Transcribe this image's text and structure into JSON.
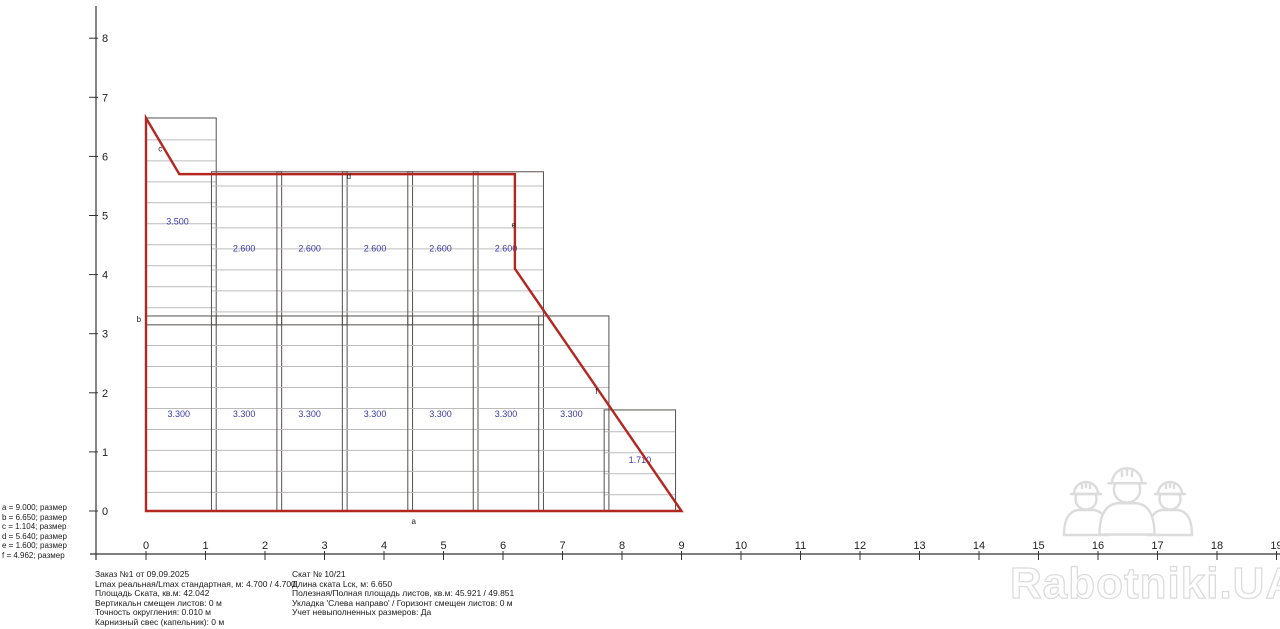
{
  "watermark": {
    "brand": "Rabotniki.UA",
    "icon": "three-workers-hardhats",
    "color_fill": "#ffffff",
    "color_stroke": "#dcdcdc"
  },
  "legend": {
    "items": [
      "a = 9.000; размер",
      "b = 6.650; размер",
      "c = 1.104; размер",
      "d = 5.640; размер",
      "e = 1.600; размер",
      "f = 4.962; размер"
    ]
  },
  "info_left": {
    "lines": [
      "Заказ №1 от 09.09.2025",
      "Lmax реальная/Lmax стандартная, м: 4.700 / 4.700",
      "Площадь Ската, кв.м:  42.042",
      "Вертикальн смещен листов: 0 м",
      "Точность округления: 0.010 м",
      " Карнизный свес (капельник): 0 м"
    ]
  },
  "info_right": {
    "lines": [
      "Скат № 10/21",
      "Длина ската Lск, м: 6.650",
      "Полезная/Полная площадь листов, кв.м:  45.921 / 49.851",
      "Укладка 'Слева направо' / Горизонт смещен листов: 0 м",
      "Учет невыполненных размеров: Да"
    ]
  },
  "drawing": {
    "origin_px": {
      "x": 146,
      "y": 511
    },
    "px_per_m": {
      "x": 59.5,
      "y": 59.1
    },
    "colors": {
      "outline": "#b42620",
      "sheet_border": "#55514d",
      "module_line": "#bcbcbc",
      "dim_label": "#3939a8",
      "axis": "#333333",
      "axis_text": "#222222",
      "edge_label": "#222222"
    },
    "axes": {
      "x": {
        "line_y": 554,
        "from_px": 90,
        "to_px": 1281,
        "ticks": [
          0,
          1,
          2,
          3,
          4,
          5,
          6,
          7,
          8,
          9,
          10,
          11,
          12,
          13,
          14,
          15,
          16,
          17,
          18,
          19
        ]
      },
      "y": {
        "line_x": 96,
        "from_px": 6,
        "to_px": 560,
        "ticks": [
          0,
          1,
          2,
          3,
          4,
          5,
          6,
          7,
          8
        ]
      }
    },
    "outline_points": [
      [
        0,
        6.65
      ],
      [
        0.56,
        5.7
      ],
      [
        6.2,
        5.7
      ],
      [
        6.2,
        4.1
      ],
      [
        9,
        0
      ],
      [
        0,
        0
      ]
    ],
    "sheets": [
      {
        "x": 0.0,
        "w": 1.18,
        "top": 6.65,
        "bottom": 3.15,
        "label": "3.500",
        "label_x": 0.53,
        "label_y": 4.9,
        "first": 0.37
      },
      {
        "x": 1.1,
        "w": 1.18,
        "top": 5.74,
        "bottom": 3.15,
        "label": "2.600",
        "label_x": 1.65,
        "label_y": 4.44,
        "first": 0.24
      },
      {
        "x": 2.2,
        "w": 1.18,
        "top": 5.74,
        "bottom": 3.15,
        "label": "2.600",
        "label_x": 2.75,
        "label_y": 4.44,
        "first": 0.24
      },
      {
        "x": 3.3,
        "w": 1.18,
        "top": 5.74,
        "bottom": 3.15,
        "label": "2.600",
        "label_x": 3.85,
        "label_y": 4.44,
        "first": 0.24
      },
      {
        "x": 4.4,
        "w": 1.18,
        "top": 5.74,
        "bottom": 3.15,
        "label": "2.600",
        "label_x": 4.95,
        "label_y": 4.44,
        "first": 0.24
      },
      {
        "x": 5.5,
        "w": 1.18,
        "top": 5.74,
        "bottom": 3.15,
        "label": "2.600",
        "label_x": 6.05,
        "label_y": 4.44,
        "first": 0.24
      },
      {
        "x": 0.0,
        "w": 1.18,
        "top": 3.3,
        "bottom": 0,
        "label": "3.300",
        "label_x": 0.55,
        "label_y": 1.64,
        "first": 0.5
      },
      {
        "x": 1.1,
        "w": 1.18,
        "top": 3.3,
        "bottom": 0,
        "label": "3.300",
        "label_x": 1.65,
        "label_y": 1.64,
        "first": 0.5
      },
      {
        "x": 2.2,
        "w": 1.18,
        "top": 3.3,
        "bottom": 0,
        "label": "3.300",
        "label_x": 2.75,
        "label_y": 1.64,
        "first": 0.5
      },
      {
        "x": 3.3,
        "w": 1.18,
        "top": 3.3,
        "bottom": 0,
        "label": "3.300",
        "label_x": 3.85,
        "label_y": 1.64,
        "first": 0.5
      },
      {
        "x": 4.4,
        "w": 1.18,
        "top": 3.3,
        "bottom": 0,
        "label": "3.300",
        "label_x": 4.95,
        "label_y": 1.64,
        "first": 0.5
      },
      {
        "x": 5.5,
        "w": 1.18,
        "top": 3.3,
        "bottom": 0,
        "label": "3.300",
        "label_x": 6.05,
        "label_y": 1.64,
        "first": 0.5
      },
      {
        "x": 6.6,
        "w": 1.18,
        "top": 3.3,
        "bottom": 0,
        "label": "3.300",
        "label_x": 7.15,
        "label_y": 1.64,
        "first": 0.5
      },
      {
        "x": 7.7,
        "w": 1.2,
        "top": 1.71,
        "bottom": 0,
        "label": "1.710",
        "label_x": 8.3,
        "label_y": 0.86,
        "first": 0.37
      }
    ],
    "module_spacing": 0.355,
    "edge_labels": [
      {
        "t": "a",
        "x": 4.5,
        "y": -0.22
      },
      {
        "t": "b",
        "x": -0.12,
        "y": 3.2
      },
      {
        "t": "c",
        "x": 0.24,
        "y": 6.08
      },
      {
        "t": "d",
        "x": 3.41,
        "y": 5.62
      },
      {
        "t": "e",
        "x": 6.18,
        "y": 4.8
      },
      {
        "t": "f",
        "x": 7.57,
        "y": 1.98
      }
    ]
  }
}
